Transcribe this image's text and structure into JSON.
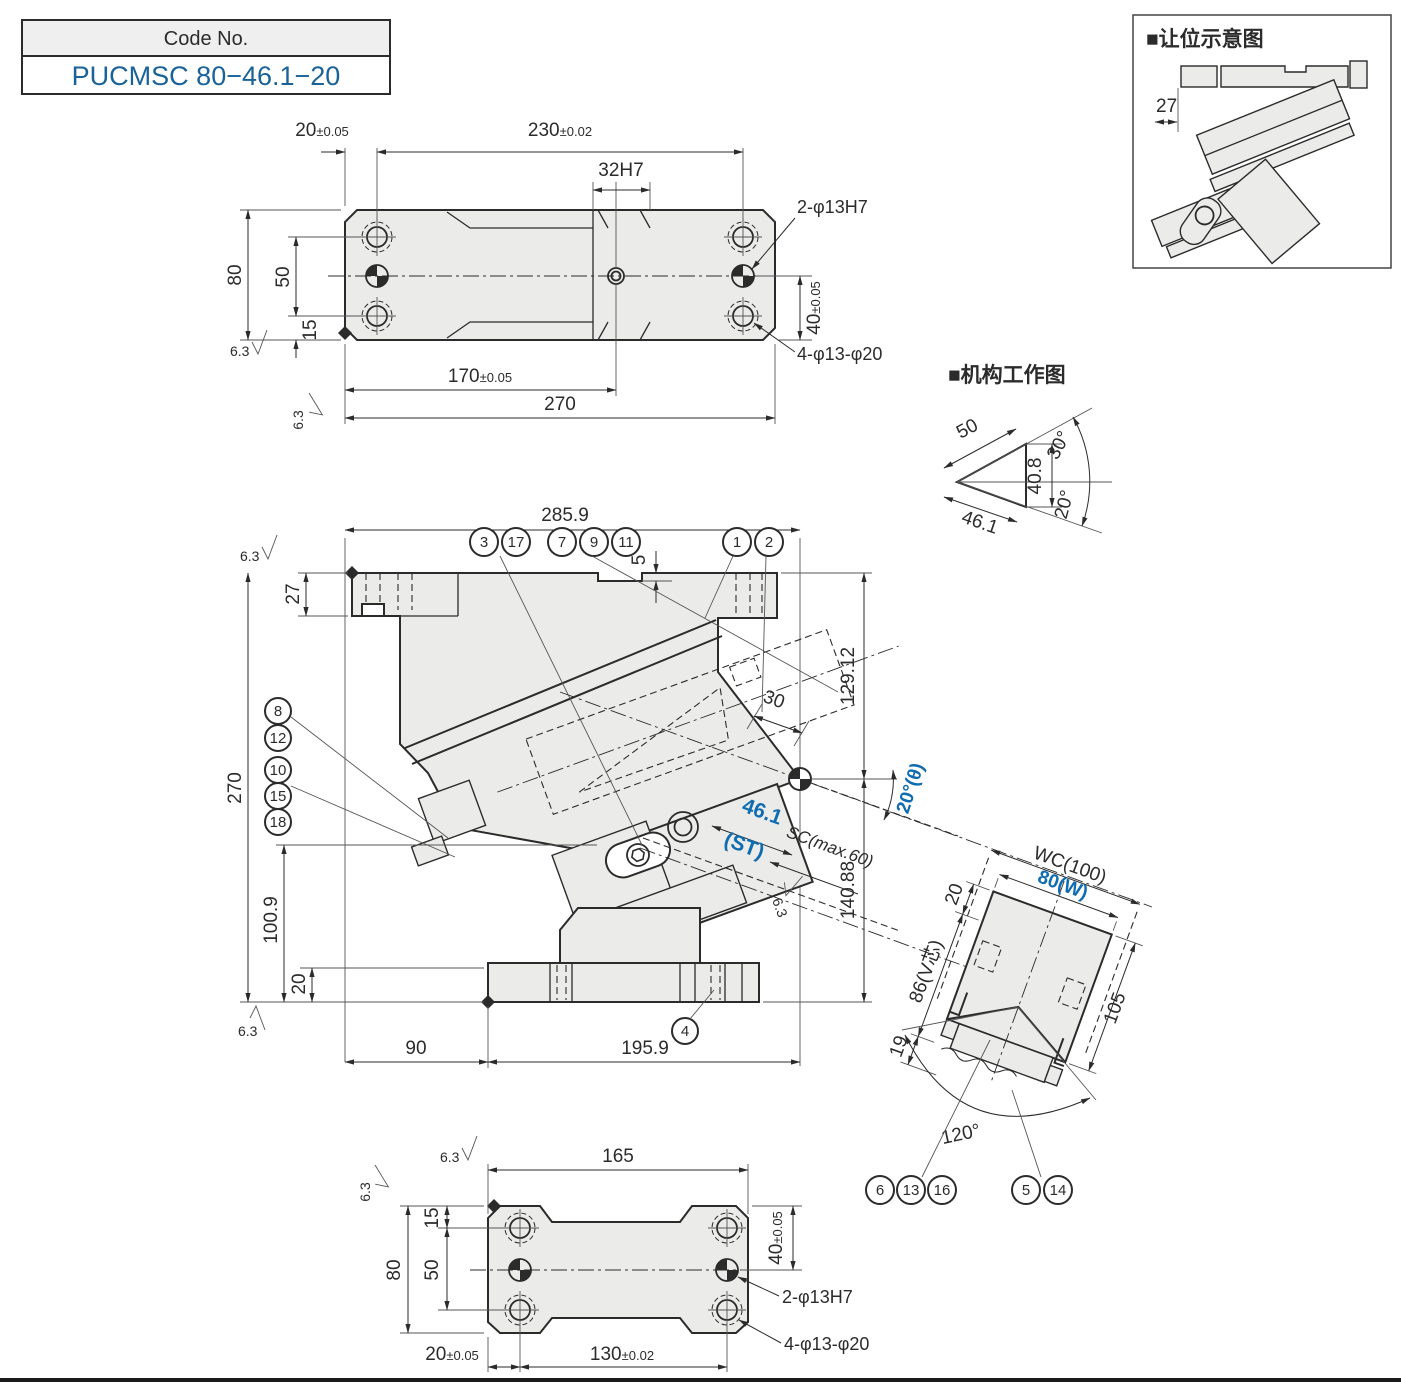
{
  "colors": {
    "paper": "#ffffff",
    "line": "#2b2b2b",
    "body_fill": "#ebecea",
    "accent_blue": "#0f6cb0",
    "code_blue": "#1a6399",
    "header_gray": "#efefef"
  },
  "code_box": {
    "header": "Code No.",
    "code": "PUCMSC 80−46.1−20"
  },
  "clearance_inset": {
    "title": "■让位示意图",
    "dim_27": "27"
  },
  "mechanism_inset": {
    "title": "■机构工作图",
    "dim_50": "50",
    "dim_408": "40.8",
    "dim_461": "46.1",
    "angle_30": "30°",
    "angle_20": "20°"
  },
  "top_view": {
    "dim_20": {
      "v": "20",
      "t": "±0.05"
    },
    "dim_230": {
      "v": "230",
      "t": "±0.02"
    },
    "dim_32h7": "32H7",
    "callout_2phi": "2-φ13H7",
    "callout_4phi": "4-φ13-φ20",
    "dim_80": "80",
    "dim_50": "50",
    "dim_15": "15",
    "dim_40": {
      "v": "40",
      "t": "±0.05"
    },
    "dim_170": {
      "v": "170",
      "t": "±0.05"
    },
    "dim_270": "270",
    "finish": "6.3"
  },
  "front_view": {
    "dim_2859": "285.9",
    "dim_5": "5",
    "dim_27": "27",
    "dim_270": "270",
    "dim_1009": "100.9",
    "dim_20": "20",
    "dim_90": "90",
    "dim_1959": "195.9",
    "dim_12912": "129.12",
    "dim_14088": "140.88",
    "dim_30": "30",
    "angle_label": "20°(θ)",
    "st_value": "46.1",
    "st_suffix": "(ST)",
    "sc_label": "SC(max.60)",
    "finish": "6.3",
    "balloons": {
      "b1": "1",
      "b2": "2",
      "b3": "3",
      "b4": "4",
      "b7": "7",
      "b8": "8",
      "b9": "9",
      "b10": "10",
      "b11": "11",
      "b12": "12",
      "b15": "15",
      "b17": "17",
      "b18": "18"
    }
  },
  "side_view": {
    "dim_wc": "WC(100)",
    "dim_w": "80(W)",
    "dim_105": "105",
    "dim_20": "20",
    "dim_86": "86(V芯)",
    "dim_19": "19",
    "angle_120": "120°",
    "balloons": {
      "b5": "5",
      "b6": "6",
      "b13": "13",
      "b14": "14",
      "b16": "16"
    }
  },
  "bottom_view": {
    "dim_165": "165",
    "dim_15": "15",
    "dim_50": "50",
    "dim_80": "80",
    "dim_40": {
      "v": "40",
      "t": "±0.05"
    },
    "dim_20": {
      "v": "20",
      "t": "±0.05"
    },
    "dim_130": {
      "v": "130",
      "t": "±0.02"
    },
    "callout_2phi": "2-φ13H7",
    "callout_4phi": "4-φ13-φ20",
    "finish": "6.3"
  }
}
